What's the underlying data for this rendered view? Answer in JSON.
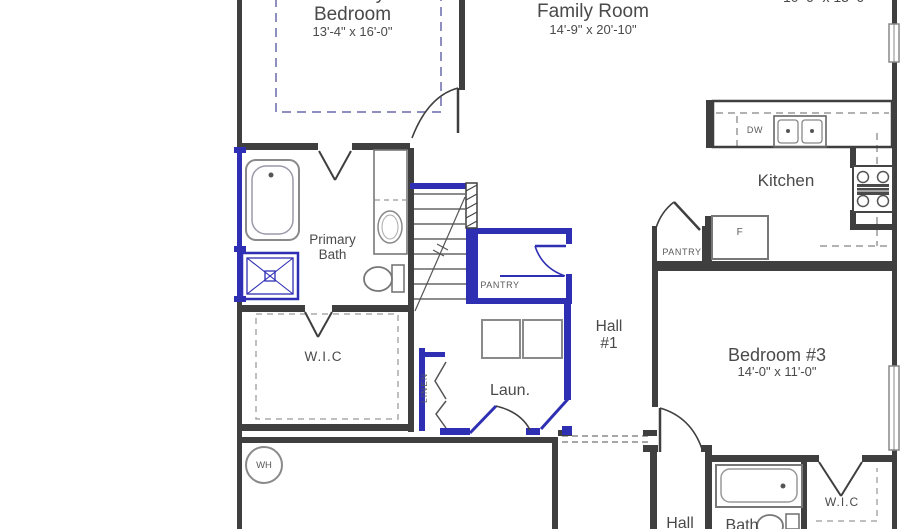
{
  "palette": {
    "wall": "#3f3f3f",
    "accent_blue": "#2f2fb4",
    "fixture_gray": "#8a8a8a",
    "text": "#4a4a4a",
    "dashed_ceiling": "#8f8fbf",
    "background": "#ffffff"
  },
  "rooms": {
    "primary_bedroom": {
      "label_line1": "Primary",
      "label_line2": "Bedroom",
      "dims": "13'-4\" x 16'-0\""
    },
    "family_room": {
      "label": "Family Room",
      "dims": "14'-9\" x 20'-10\""
    },
    "top_right_room": {
      "dims": "10'-6\" x 13'-6\""
    },
    "kitchen": {
      "label": "Kitchen"
    },
    "primary_bath": {
      "label_line1": "Primary",
      "label_line2": "Bath"
    },
    "wic_left": {
      "label": "W.I.C"
    },
    "hall_1": {
      "label_line1": "Hall",
      "label_line2": "#1"
    },
    "bedroom_3": {
      "label": "Bedroom #3",
      "dims": "14'-0\" x 11'-0\""
    },
    "laundry": {
      "label": "Laun."
    },
    "pantry_stairs": {
      "label": "PANTRY"
    },
    "pantry_kitchen": {
      "label": "PANTRY"
    },
    "linen": {
      "label": "LINEN"
    },
    "wic_right": {
      "label": "W.I.C"
    },
    "hall_lower": {
      "label": "Hall"
    },
    "bath_2": {
      "label": "Bath"
    }
  },
  "fixtures": {
    "dishwasher": "DW",
    "refrigerator": "F",
    "water_heater": "WH"
  }
}
